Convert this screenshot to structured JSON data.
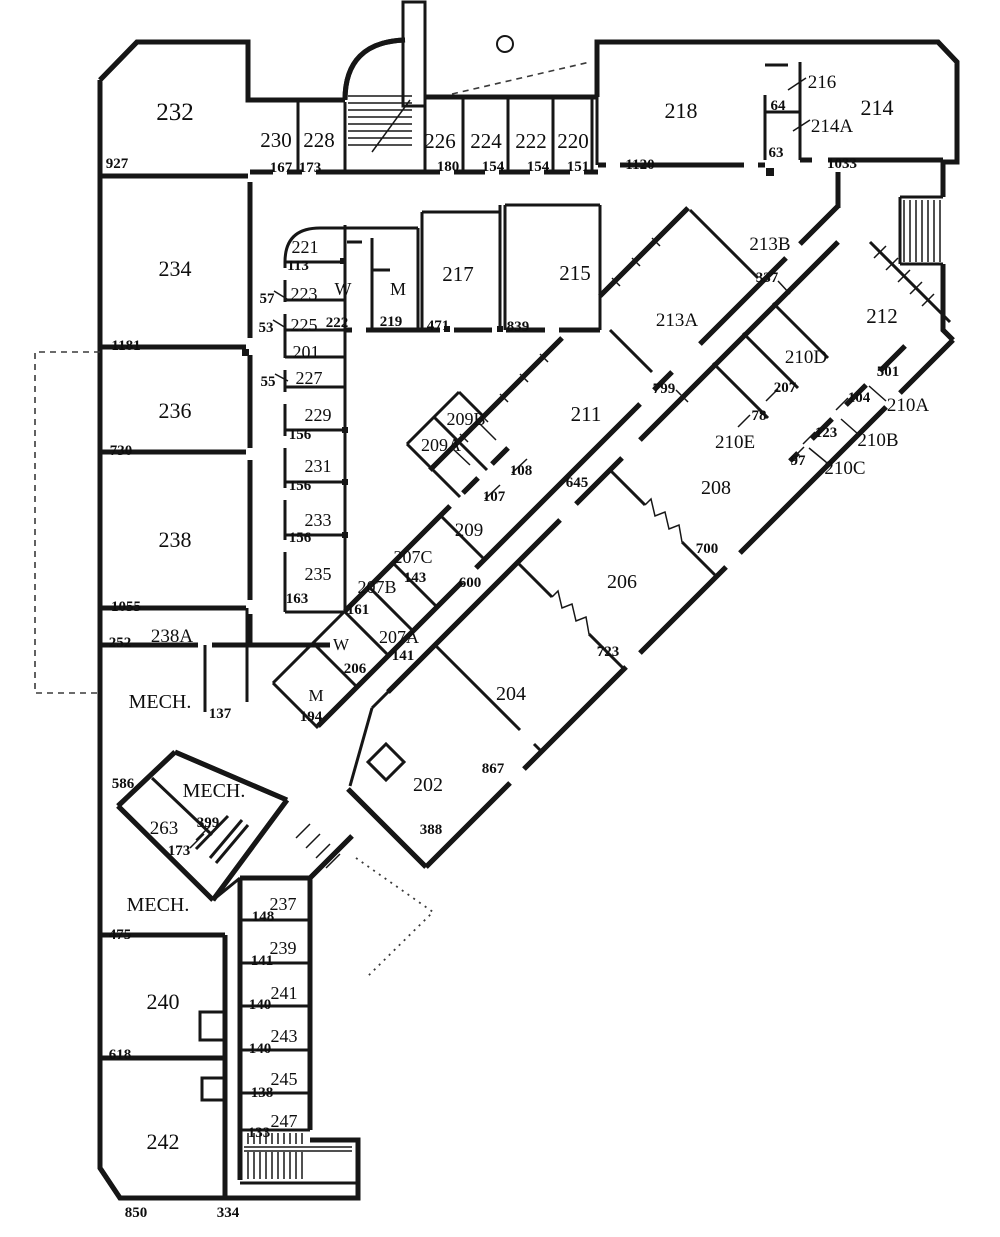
{
  "floor_plan": {
    "rooms": [
      {
        "label": "232",
        "x": 175,
        "y": 113,
        "size": 25
      },
      {
        "label": "230",
        "x": 276,
        "y": 140,
        "size": 21
      },
      {
        "label": "228",
        "x": 319,
        "y": 140,
        "size": 21
      },
      {
        "label": "226",
        "x": 440,
        "y": 141,
        "size": 21
      },
      {
        "label": "224",
        "x": 486,
        "y": 141,
        "size": 21
      },
      {
        "label": "222",
        "x": 531,
        "y": 141,
        "size": 21
      },
      {
        "label": "220",
        "x": 573,
        "y": 141,
        "size": 21
      },
      {
        "label": "218",
        "x": 681,
        "y": 111,
        "size": 22
      },
      {
        "label": "216",
        "x": 822,
        "y": 81,
        "size": 19
      },
      {
        "label": "214A",
        "x": 832,
        "y": 125,
        "size": 19
      },
      {
        "label": "214",
        "x": 877,
        "y": 108,
        "size": 22
      },
      {
        "label": "234",
        "x": 175,
        "y": 269,
        "size": 22
      },
      {
        "label": "236",
        "x": 175,
        "y": 411,
        "size": 22
      },
      {
        "label": "238",
        "x": 175,
        "y": 540,
        "size": 22
      },
      {
        "label": "238A",
        "x": 172,
        "y": 635,
        "size": 19
      },
      {
        "label": "MECH.",
        "x": 160,
        "y": 701,
        "size": 20
      },
      {
        "label": "MECH.",
        "x": 214,
        "y": 790,
        "size": 20
      },
      {
        "label": "263",
        "x": 164,
        "y": 827,
        "size": 19
      },
      {
        "label": "MECH.",
        "x": 158,
        "y": 904,
        "size": 20
      },
      {
        "label": "240",
        "x": 163,
        "y": 1002,
        "size": 22
      },
      {
        "label": "242",
        "x": 163,
        "y": 1142,
        "size": 22
      },
      {
        "label": "221",
        "x": 305,
        "y": 246,
        "size": 18
      },
      {
        "label": "223",
        "x": 304,
        "y": 293,
        "size": 18
      },
      {
        "label": "225",
        "x": 304,
        "y": 324,
        "size": 18
      },
      {
        "label": "201",
        "x": 306,
        "y": 351,
        "size": 18
      },
      {
        "label": "227",
        "x": 309,
        "y": 377,
        "size": 18
      },
      {
        "label": "229",
        "x": 318,
        "y": 414,
        "size": 18
      },
      {
        "label": "231",
        "x": 318,
        "y": 465,
        "size": 18
      },
      {
        "label": "233",
        "x": 318,
        "y": 519,
        "size": 18
      },
      {
        "label": "235",
        "x": 318,
        "y": 573,
        "size": 18
      },
      {
        "label": "W",
        "x": 343,
        "y": 288,
        "size": 18
      },
      {
        "label": "M",
        "x": 398,
        "y": 288,
        "size": 18
      },
      {
        "label": "217",
        "x": 458,
        "y": 274,
        "size": 21
      },
      {
        "label": "215",
        "x": 575,
        "y": 273,
        "size": 21
      },
      {
        "label": "213B",
        "x": 770,
        "y": 243,
        "size": 19
      },
      {
        "label": "213A",
        "x": 677,
        "y": 319,
        "size": 19
      },
      {
        "label": "212",
        "x": 882,
        "y": 316,
        "size": 21
      },
      {
        "label": "210D",
        "x": 806,
        "y": 356,
        "size": 19
      },
      {
        "label": "210A",
        "x": 908,
        "y": 404,
        "size": 19
      },
      {
        "label": "210E",
        "x": 735,
        "y": 441,
        "size": 19
      },
      {
        "label": "210B",
        "x": 878,
        "y": 439,
        "size": 19
      },
      {
        "label": "210C",
        "x": 845,
        "y": 467,
        "size": 19
      },
      {
        "label": "208",
        "x": 716,
        "y": 487,
        "size": 20
      },
      {
        "label": "211",
        "x": 586,
        "y": 414,
        "size": 21
      },
      {
        "label": "209B",
        "x": 466,
        "y": 418,
        "size": 18
      },
      {
        "label": "209A",
        "x": 441,
        "y": 444,
        "size": 18
      },
      {
        "label": "209",
        "x": 469,
        "y": 529,
        "size": 19
      },
      {
        "label": "207C",
        "x": 413,
        "y": 556,
        "size": 18
      },
      {
        "label": "207B",
        "x": 377,
        "y": 586,
        "size": 18
      },
      {
        "label": "207A",
        "x": 399,
        "y": 636,
        "size": 18
      },
      {
        "label": "W",
        "x": 341,
        "y": 643,
        "size": 17
      },
      {
        "label": "M",
        "x": 316,
        "y": 694,
        "size": 17
      },
      {
        "label": "206",
        "x": 622,
        "y": 581,
        "size": 20
      },
      {
        "label": "204",
        "x": 511,
        "y": 693,
        "size": 20
      },
      {
        "label": "202",
        "x": 428,
        "y": 784,
        "size": 20
      },
      {
        "label": "237",
        "x": 283,
        "y": 903,
        "size": 18
      },
      {
        "label": "239",
        "x": 283,
        "y": 947,
        "size": 18
      },
      {
        "label": "241",
        "x": 284,
        "y": 992,
        "size": 18
      },
      {
        "label": "243",
        "x": 284,
        "y": 1035,
        "size": 18
      },
      {
        "label": "245",
        "x": 284,
        "y": 1078,
        "size": 18
      },
      {
        "label": "247",
        "x": 284,
        "y": 1120,
        "size": 18
      }
    ],
    "dimensions": [
      {
        "label": "927",
        "x": 117,
        "y": 163
      },
      {
        "label": "167",
        "x": 281,
        "y": 167
      },
      {
        "label": "173",
        "x": 310,
        "y": 167
      },
      {
        "label": "180",
        "x": 448,
        "y": 166
      },
      {
        "label": "154",
        "x": 493,
        "y": 166
      },
      {
        "label": "154",
        "x": 538,
        "y": 166
      },
      {
        "label": "151",
        "x": 578,
        "y": 166
      },
      {
        "label": "1120",
        "x": 640,
        "y": 164
      },
      {
        "label": "64",
        "x": 778,
        "y": 105
      },
      {
        "label": "63",
        "x": 776,
        "y": 152
      },
      {
        "label": "1033",
        "x": 842,
        "y": 163
      },
      {
        "label": "113",
        "x": 298,
        "y": 265
      },
      {
        "label": "57",
        "x": 267,
        "y": 298
      },
      {
        "label": "53",
        "x": 266,
        "y": 327
      },
      {
        "label": "55",
        "x": 268,
        "y": 381
      },
      {
        "label": "222",
        "x": 337,
        "y": 322
      },
      {
        "label": "219",
        "x": 391,
        "y": 321
      },
      {
        "label": "471",
        "x": 438,
        "y": 325
      },
      {
        "label": "839",
        "x": 518,
        "y": 326
      },
      {
        "label": "156",
        "x": 300,
        "y": 434
      },
      {
        "label": "156",
        "x": 300,
        "y": 485
      },
      {
        "label": "156",
        "x": 300,
        "y": 537
      },
      {
        "label": "163",
        "x": 297,
        "y": 598
      },
      {
        "label": "1181",
        "x": 126,
        "y": 345
      },
      {
        "label": "730",
        "x": 121,
        "y": 450
      },
      {
        "label": "1055",
        "x": 126,
        "y": 606
      },
      {
        "label": "252",
        "x": 120,
        "y": 642
      },
      {
        "label": "137",
        "x": 220,
        "y": 713
      },
      {
        "label": "586",
        "x": 123,
        "y": 783
      },
      {
        "label": "399",
        "x": 208,
        "y": 822
      },
      {
        "label": "173",
        "x": 179,
        "y": 850
      },
      {
        "label": "475",
        "x": 120,
        "y": 934
      },
      {
        "label": "618",
        "x": 120,
        "y": 1054
      },
      {
        "label": "850",
        "x": 136,
        "y": 1212
      },
      {
        "label": "334",
        "x": 228,
        "y": 1212
      },
      {
        "label": "148",
        "x": 263,
        "y": 916
      },
      {
        "label": "141",
        "x": 262,
        "y": 960
      },
      {
        "label": "140",
        "x": 260,
        "y": 1004
      },
      {
        "label": "140",
        "x": 260,
        "y": 1048
      },
      {
        "label": "138",
        "x": 262,
        "y": 1092
      },
      {
        "label": "133",
        "x": 259,
        "y": 1132
      },
      {
        "label": "337",
        "x": 767,
        "y": 277
      },
      {
        "label": "799",
        "x": 664,
        "y": 388
      },
      {
        "label": "501",
        "x": 888,
        "y": 371
      },
      {
        "label": "207",
        "x": 785,
        "y": 387
      },
      {
        "label": "104",
        "x": 859,
        "y": 397
      },
      {
        "label": "78",
        "x": 759,
        "y": 415
      },
      {
        "label": "123",
        "x": 826,
        "y": 432
      },
      {
        "label": "97",
        "x": 798,
        "y": 460
      },
      {
        "label": "700",
        "x": 707,
        "y": 548
      },
      {
        "label": "645",
        "x": 577,
        "y": 482
      },
      {
        "label": "108",
        "x": 521,
        "y": 470
      },
      {
        "label": "107",
        "x": 494,
        "y": 496
      },
      {
        "label": "143",
        "x": 415,
        "y": 577
      },
      {
        "label": "161",
        "x": 358,
        "y": 609
      },
      {
        "label": "141",
        "x": 403,
        "y": 655
      },
      {
        "label": "206",
        "x": 355,
        "y": 668
      },
      {
        "label": "194",
        "x": 311,
        "y": 716
      },
      {
        "label": "600",
        "x": 470,
        "y": 582
      },
      {
        "label": "723",
        "x": 608,
        "y": 651
      },
      {
        "label": "867",
        "x": 493,
        "y": 768
      },
      {
        "label": "388",
        "x": 431,
        "y": 829
      }
    ]
  }
}
